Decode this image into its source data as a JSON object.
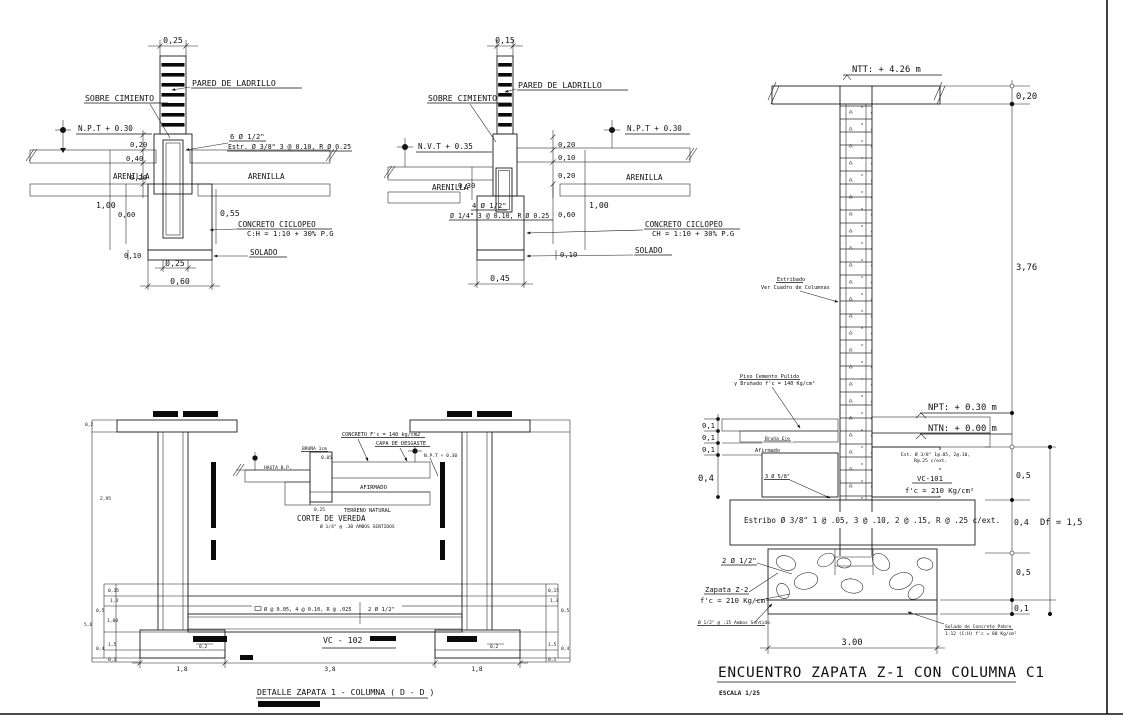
{
  "a": {
    "top_dim": "0,25",
    "pared": "PARED DE LADRILLO",
    "sobre": "SOBRE CIMIENTO",
    "level": "N.P.T  +  0.30",
    "arenilla_l": "ARENILLA",
    "arenilla_r": "ARENILLA",
    "rebar_a": "6 Ø 1/2\"",
    "rebar_b": "Estr. Ø 3/8\" 3 @ 0.10, R Ø 0.25",
    "conc_a": "CONCRETO CICLOPEO",
    "conc_b": "C:H = 1:10 + 30% P.G",
    "solado": "SOLADO",
    "d020a": "0,20",
    "d040": "0,40",
    "d020b": "0,20",
    "d100": "1,00",
    "d060": "0,60",
    "d055": "0,55",
    "d010": "0,10",
    "d025": "0,25",
    "d060b": "0,60"
  },
  "b": {
    "top_dim": "0,15",
    "pared": "PARED DE LADRILLO",
    "sobre": "SOBRE CIMIENTO",
    "nvt": "N.V.T  +  0.35",
    "npt": "N.P.T  +  0.30",
    "arenilla_l": "ARENILLA",
    "arenilla_r": "ARENILLA",
    "rebar_a": "4 Ø 1/2\"",
    "rebar_b": "Ø 1/4\" 3 @ 0.10, R Ø 0.25",
    "conc_a": "CONCRETO CICLOPEO",
    "conc_b": "CH = 1:10 + 30% P.G",
    "solado": "SOLADO",
    "d020a": "0,20",
    "d010a": "0,10",
    "d020b": "0,20",
    "d030": "0,30",
    "d100": "1,00",
    "d060": "0,60",
    "d010b": "0,10",
    "d045": "0,45"
  },
  "c": {
    "ntt": "NTT: + 4.26 m",
    "d020": "0,20",
    "d376": "3,76",
    "estribado_a": "Estribado",
    "estribado_b": "Ver Cuadro de Columnas",
    "piso_a": "Piso Cemento Pulido",
    "piso_b": "y Bruñado f'c = 140 Kg/cm²",
    "npt": "NPT: + 0.30 m",
    "ntn": "NTN: + 0.00 m",
    "d01a": "0,1",
    "d01b": "0,1",
    "d01c": "0,1",
    "d04": "0,4",
    "bruna": "Bruña Eje",
    "afirmado": "Afirmado",
    "bars": "3 Ø 5/8\"",
    "est_a": "Est. Ø 3/8\" 1@.05, 2@.10,",
    "est_b": "R@.25 c/ext.",
    "vc": "VC-101",
    "fc": "f'c = 210 Kg/cm²",
    "d05a": "0,5",
    "estribo": "Estribo Ø 3/8\" 1 @ .05, 3 @ .10, 2 @ .15, R @ .25 c/ext.",
    "d04b": "0,4",
    "df": "Df  =  1,5",
    "rebar": "2 Ø 1/2\"",
    "d05b": "0,5",
    "zapata_a": "Zapata Z-2",
    "zapata_b": "f'c = 210 Kg/cm²",
    "ambos": "Ø 1/2\" @ .15 Ambos Sentido",
    "d01d": "0,1",
    "solado_a": "Solado de Concreto Pobre",
    "solado_b": "1:12 (C:H) f'c = 80 Kg/cm²",
    "d300": "3.00",
    "title": "ENCUENTRO ZAPATA  Z-1  CON COLUMNA C1",
    "escala": "ESCALA 1/25"
  },
  "d": {
    "vc": "VC - 102",
    "note_a": "Ø @ 0.05, 4 @ 0.10, R @ .025",
    "note_b": "2 Ø 1/2\"",
    "dim_l": "1,8",
    "dim_m": "3,8",
    "dim_r": "1,8",
    "d02a": "0,2",
    "d02b": "0,2",
    "left": [
      "0,15",
      "1,3",
      "0,5",
      "1,00",
      "5,6",
      "1,5",
      "0,4",
      "0,1"
    ],
    "right": [
      "0,15",
      "1,3",
      "0,5",
      "1,5",
      "0,4",
      "0,1"
    ],
    "stem_a": "0,2",
    "stem_b": "2,95",
    "title": "DETALLE ZAPATA  1 - COLUMNA ( D - D )"
  },
  "v": {
    "concreto": "CONCRETO F'c = 140 kg/cm2",
    "capa": "CAPA DE DESGASTE",
    "bruna": "BRUÑA 1cm",
    "d005": "0,05",
    "hasta": "HASTA B.P.",
    "npt": "N.P.T + 0.30",
    "afirmado": "AFIRMADO",
    "terreno": "TERRENO NATURAL",
    "d025": "0,25",
    "caption": "CORTE DE VEREDA",
    "caption_sub": "Ø 1/4\" @ .30 AMBOS SENTIDOS"
  }
}
